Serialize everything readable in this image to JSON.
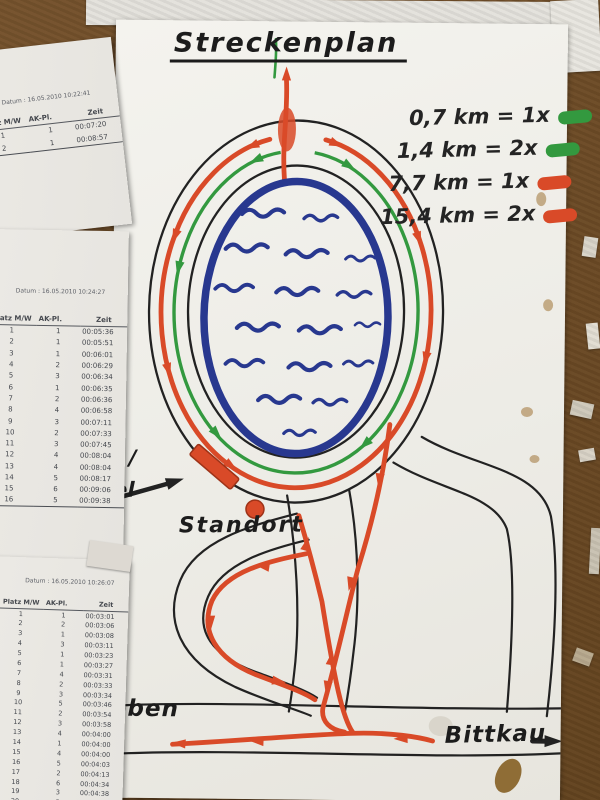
{
  "colors": {
    "route-red": "#d94a28",
    "route-green": "#33993f",
    "lake-blue": "#28388f",
    "ink": "#222222",
    "cork": "#6f4d28"
  },
  "map": {
    "title": "Streckenplan",
    "legend": [
      {
        "label": "0,7 km = 1x",
        "color": "green"
      },
      {
        "label": "1,4 km = 2x",
        "color": "green"
      },
      {
        "label": "7,7 km = 1x",
        "color": "red"
      },
      {
        "label": "15,4 km = 2x",
        "color": "red"
      }
    ],
    "labels": {
      "standort": "Standort",
      "start_fragment_top": "t /",
      "start_fragment_bottom": "el",
      "town_left": "eben",
      "town_right": "Bittkau"
    }
  },
  "sheets": [
    {
      "date_label": "Datum :",
      "date": "16.05.2010 10:22:41",
      "columns": [
        "Platz M/W",
        "AK-Pl.",
        "Zeit"
      ],
      "rows": [
        [
          "1",
          "1",
          "00:07:20"
        ],
        [
          "2",
          "1",
          "00:08:57"
        ]
      ]
    },
    {
      "date_label": "Datum :",
      "date": "16.05.2010 10:24:27",
      "columns": [
        "Platz M/W",
        "AK-Pl.",
        "Zeit"
      ],
      "rows": [
        [
          "1",
          "1",
          "00:05:36"
        ],
        [
          "2",
          "1",
          "00:05:51"
        ],
        [
          "3",
          "1",
          "00:06:01"
        ],
        [
          "4",
          "2",
          "00:06:29"
        ],
        [
          "5",
          "3",
          "00:06:34"
        ],
        [
          "6",
          "1",
          "00:06:35"
        ],
        [
          "7",
          "2",
          "00:06:36"
        ],
        [
          "8",
          "4",
          "00:06:58"
        ],
        [
          "9",
          "3",
          "00:07:11"
        ],
        [
          "10",
          "2",
          "00:07:33"
        ],
        [
          "11",
          "3",
          "00:07:45"
        ],
        [
          "12",
          "4",
          "00:08:04"
        ],
        [
          "13",
          "4",
          "00:08:04"
        ],
        [
          "14",
          "5",
          "00:08:17"
        ],
        [
          "15",
          "6",
          "00:09:06"
        ],
        [
          "16",
          "5",
          "00:09:38"
        ]
      ]
    },
    {
      "date_label": "Datum :",
      "date": "16.05.2010 10:26:07",
      "columns": [
        "Platz M/W",
        "AK-Pl.",
        "Zeit"
      ],
      "rows": [
        [
          "1",
          "1",
          "00:03:01"
        ],
        [
          "2",
          "2",
          "00:03:06"
        ],
        [
          "3",
          "1",
          "00:03:08"
        ],
        [
          "4",
          "3",
          "00:03:11"
        ],
        [
          "5",
          "1",
          "00:03:23"
        ],
        [
          "6",
          "1",
          "00:03:27"
        ],
        [
          "7",
          "4",
          "00:03:31"
        ],
        [
          "8",
          "2",
          "00:03:33"
        ],
        [
          "9",
          "3",
          "00:03:34"
        ],
        [
          "10",
          "5",
          "00:03:46"
        ],
        [
          "11",
          "2",
          "00:03:54"
        ],
        [
          "12",
          "3",
          "00:03:58"
        ],
        [
          "13",
          "4",
          "00:04:00"
        ],
        [
          "14",
          "1",
          "00:04:00"
        ],
        [
          "15",
          "4",
          "00:04:00"
        ],
        [
          "16",
          "5",
          "00:04:03"
        ],
        [
          "17",
          "2",
          "00:04:13"
        ],
        [
          "18",
          "6",
          "00:04:34"
        ],
        [
          "19",
          "3",
          "00:04:38"
        ],
        [
          "20",
          "5",
          "00:04:49"
        ]
      ],
      "edge_fragments": [
        "0",
        "3",
        "9",
        "0",
        "3",
        "1",
        "0",
        "8",
        "9",
        "0",
        "9",
        "9",
        "8",
        "7",
        "8",
        "9",
        "7",
        "8",
        "7",
        ""
      ]
    }
  ]
}
